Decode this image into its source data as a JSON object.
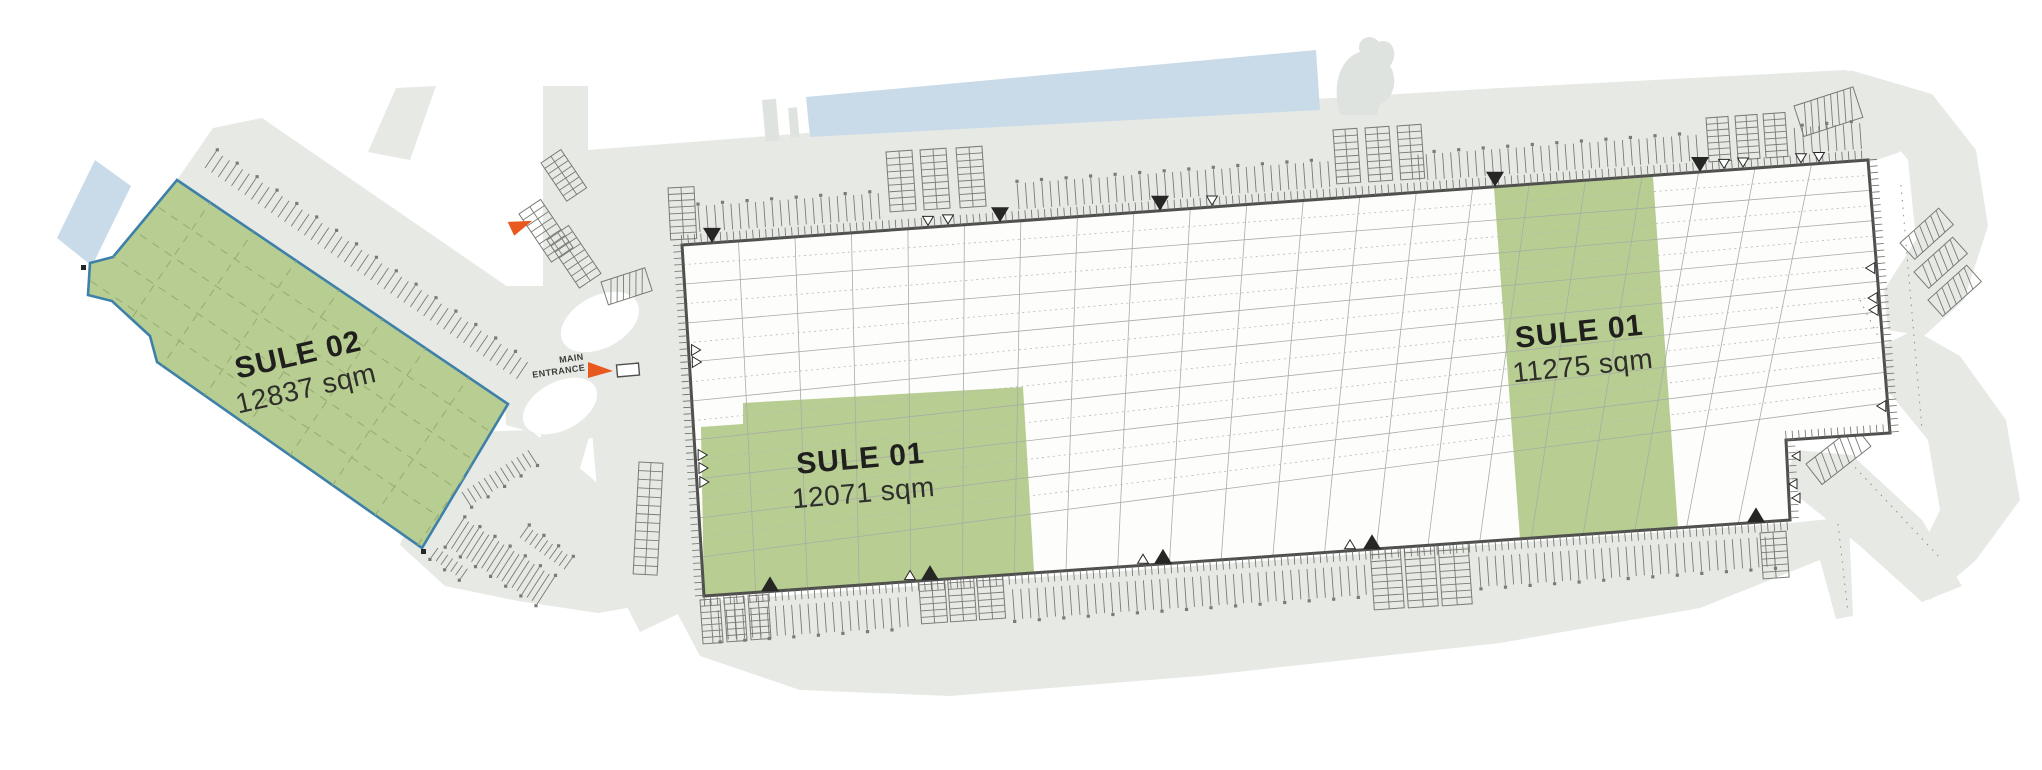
{
  "site_plan": {
    "units": [
      {
        "id": "sule-02",
        "name": "SULE 02",
        "area": "12837 sqm",
        "status": "available"
      },
      {
        "id": "sule-01-a",
        "name": "SULE 01",
        "area": "12071 sqm",
        "status": "available"
      },
      {
        "id": "sule-01-b",
        "name": "SULE 01",
        "area": "11275 sqm",
        "status": "available"
      }
    ],
    "entrance": {
      "line1": "MAIN",
      "line2": "ENTRANCE"
    },
    "colors": {
      "available_green": "#b8cd92",
      "green_grid_line": "#97ad74",
      "unit_outline_blue": "#3e80a8",
      "road_gray": "#e7e9e5",
      "road_gray_soft": "#edefec",
      "water_blue": "#c9dbe9",
      "entrance_orange": "#e8591f",
      "building_outline": "#4f4f4d",
      "grid_line": "#a8ada5",
      "grid_dotted": "#b6bab2",
      "tick_gray": "#6a6e66",
      "stall_gray": "#787c74",
      "mark_dark": "#262624",
      "text_dark": "#1f1f1d"
    }
  }
}
